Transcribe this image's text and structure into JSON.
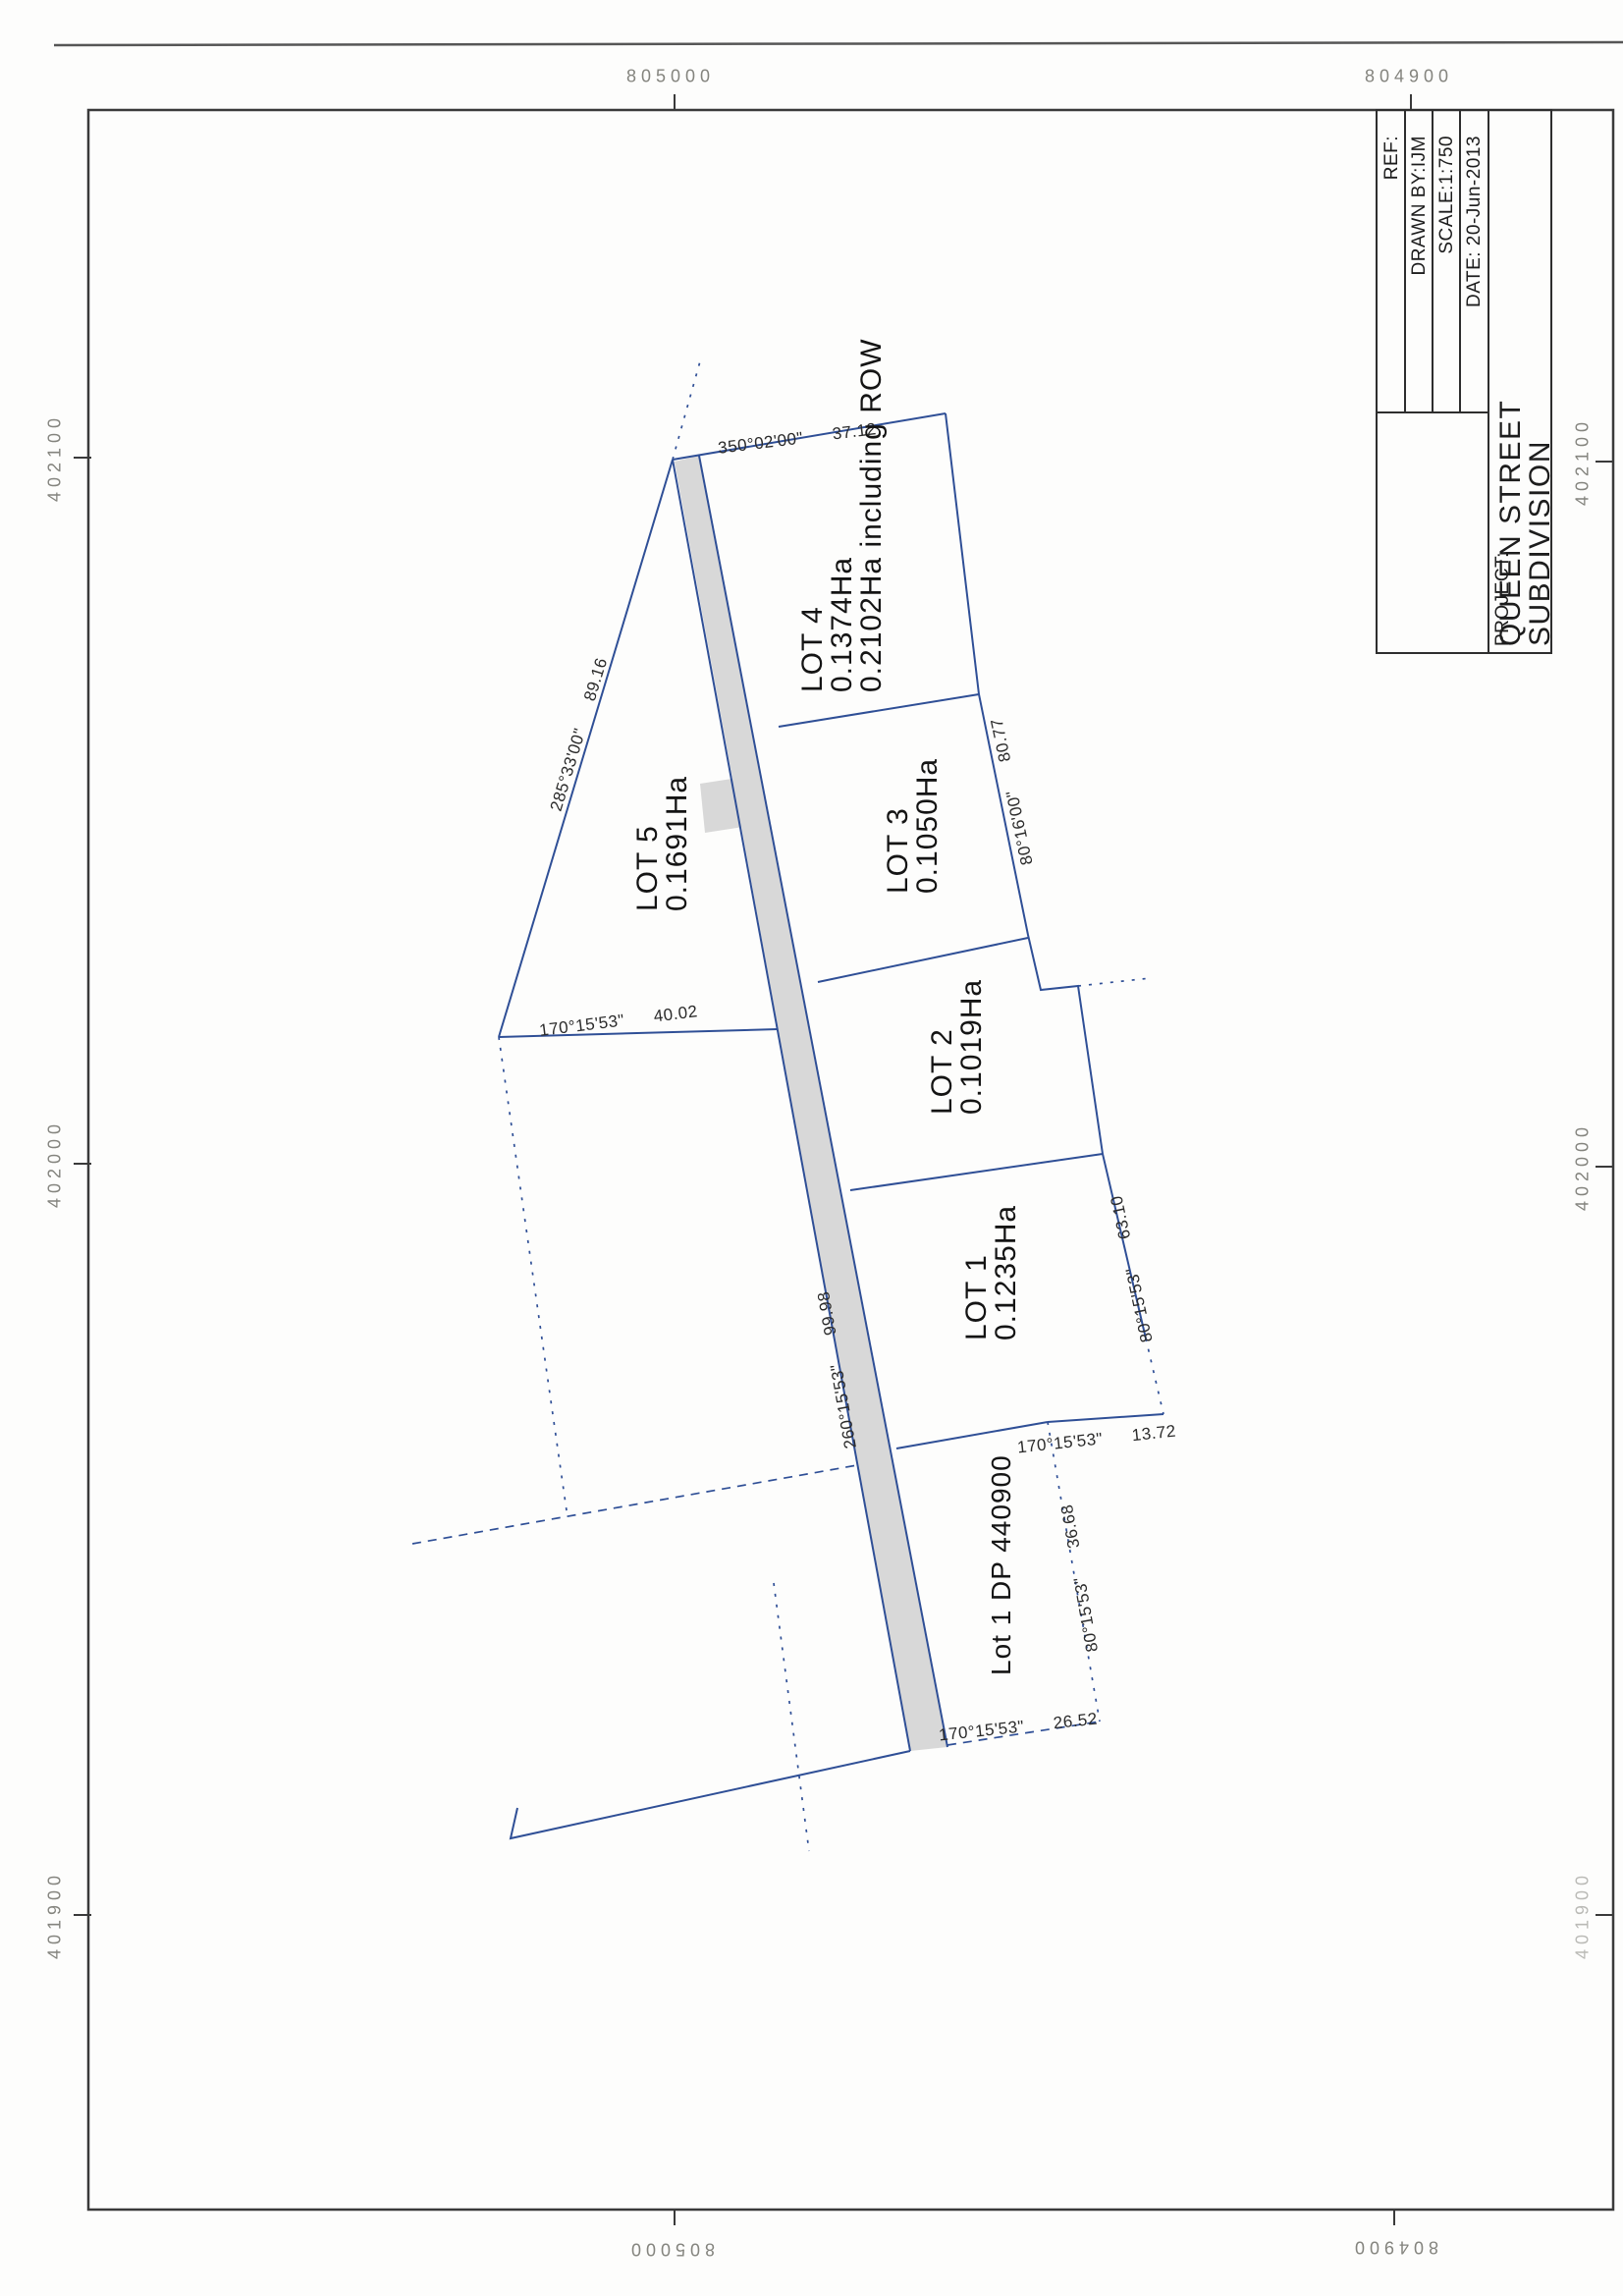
{
  "title_block": {
    "ref": "REF:",
    "drawn_by": "DRAWN BY:IJM",
    "scale": "SCALE:1:750",
    "date": "DATE: 20-Jun-2013",
    "project_label": "PROJECT:",
    "project_line1": "QUEEN STREET",
    "project_line2": "SUBDIVISION"
  },
  "grid": {
    "top": [
      "805000",
      "804900"
    ],
    "bottom": [
      "805000",
      "804900"
    ],
    "left": [
      "402100",
      "402000",
      "401900"
    ],
    "right": [
      "402100",
      "402000",
      "401900"
    ]
  },
  "lots": {
    "lot5": [
      "LOT 5",
      "0.1691Ha"
    ],
    "lot4": [
      "LOT 4",
      "0.1374Ha",
      "0.2102Ha including ROW"
    ],
    "lot3": [
      "LOT 3",
      "0.1050Ha"
    ],
    "lot2": [
      "LOT 2",
      "0.1019Ha"
    ],
    "lot1": [
      "LOT 1",
      "0.1235Ha"
    ],
    "neighbour": "Lot 1 DP 440900"
  },
  "bearings": [
    {
      "bearing": "350°02'00\"",
      "distance": "37.12"
    },
    {
      "bearing": "285°33'00\"",
      "distance": "89.16"
    },
    {
      "bearing": "170°15'53\"",
      "distance": "40.02"
    },
    {
      "bearing": "80°16'00\"",
      "distance": "80.77"
    },
    {
      "bearing": "80°15'53\"",
      "distance": "63.10"
    },
    {
      "bearing": "170°15'53\"",
      "distance": "13.72"
    },
    {
      "bearing": "260°15'53\"",
      "distance": "99.98"
    },
    {
      "bearing": "80°15'53\"",
      "distance": "36.68"
    },
    {
      "bearing": "170°15'53\"",
      "distance": "26.52"
    }
  ],
  "colors": {
    "boundary_blue": "#2f4f96",
    "road_gray": "#d8d8d8",
    "frame": "#3a3a3a",
    "grid_label_gray": "#84847e"
  }
}
